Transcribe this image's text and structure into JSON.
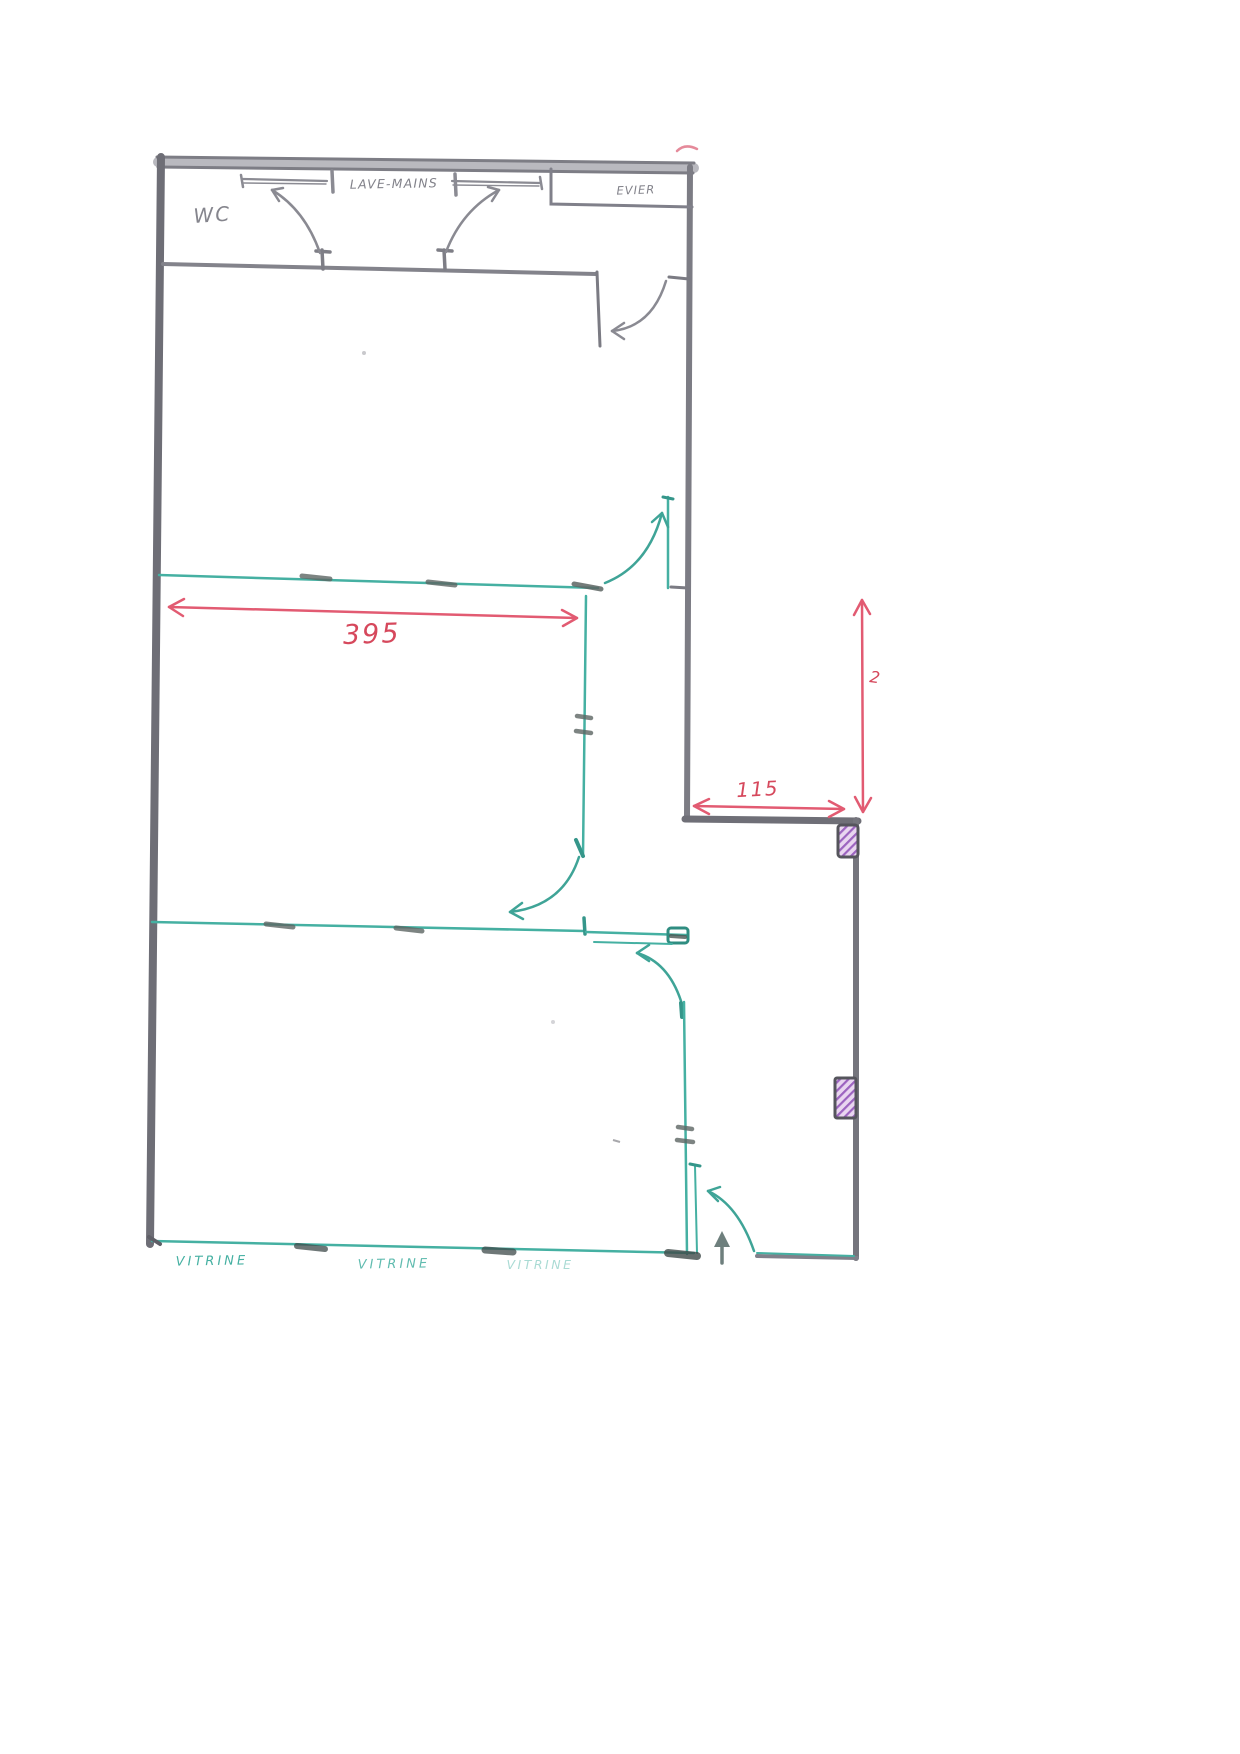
{
  "document": {
    "kind": "scanned hand-drawn floor plan",
    "paper_color": "#ffffff"
  },
  "labels": {
    "wc": "WC",
    "lave_mains": "LAVE-MAINS",
    "evier": "EVIER",
    "vitrine_left": "VITRINE",
    "vitrine_middle": "VITRINE",
    "vitrine_right": "VITRINE"
  },
  "dimensions": {
    "room_width": {
      "value": "395",
      "orientation": "horizontal",
      "color": "#d6485c"
    },
    "recess_width": {
      "value": "115",
      "orientation": "horizontal",
      "color": "#d6485c"
    },
    "right_side_note": {
      "value": "2",
      "orientation": "vertical",
      "color": "#d6485c"
    }
  },
  "colors": {
    "pencil_wall": "#76767e",
    "partition_teal": "#45b0a2",
    "dimension_red": "#e25b72",
    "fixture_purple": "#9c64c0",
    "jamb_dark": "#4a5553",
    "handwriting_gray": "#85858d"
  }
}
